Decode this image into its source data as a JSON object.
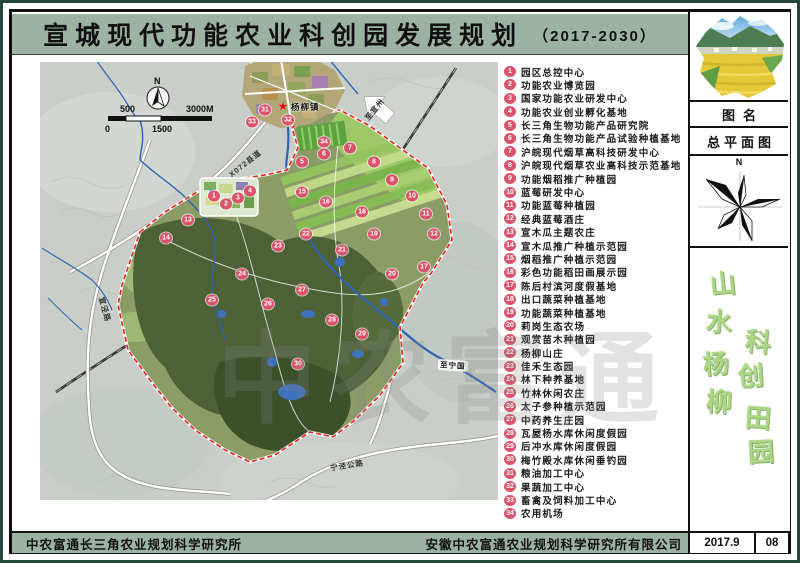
{
  "title": {
    "main": "宣城现代功能农业科创园发展规划",
    "period": "（2017-2030）"
  },
  "legend": {
    "items": [
      {
        "num": "1",
        "label": "园区总控中心"
      },
      {
        "num": "2",
        "label": "功能农业博览园"
      },
      {
        "num": "3",
        "label": "国家功能农业研发中心"
      },
      {
        "num": "4",
        "label": "功能农业创业孵化基地"
      },
      {
        "num": "5",
        "label": "长三角生物功能产品研究院"
      },
      {
        "num": "6",
        "label": "长三角生物功能产品试验种植基地"
      },
      {
        "num": "7",
        "label": "沪皖现代烟草高科技研发中心"
      },
      {
        "num": "8",
        "label": "沪皖现代烟草农业高科技示范基地"
      },
      {
        "num": "9",
        "label": "功能烟稻推广种植园"
      },
      {
        "num": "10",
        "label": "蓝莓研发中心"
      },
      {
        "num": "11",
        "label": "功能蓝莓种植园"
      },
      {
        "num": "12",
        "label": "经典蓝莓酒庄"
      },
      {
        "num": "13",
        "label": "宣木瓜主题农庄"
      },
      {
        "num": "14",
        "label": "宣木瓜推广种植示范园"
      },
      {
        "num": "15",
        "label": "烟稻推广种植示范园"
      },
      {
        "num": "16",
        "label": "彩色功能稻田画展示园"
      },
      {
        "num": "17",
        "label": "陈后村滨河度假基地"
      },
      {
        "num": "18",
        "label": "出口蔬菜种植基地"
      },
      {
        "num": "19",
        "label": "功能蔬菜种植基地"
      },
      {
        "num": "20",
        "label": "莉岗生态农场"
      },
      {
        "num": "21",
        "label": "观赏苗木种植园"
      },
      {
        "num": "22",
        "label": "杨柳山庄"
      },
      {
        "num": "23",
        "label": "佳禾生态园"
      },
      {
        "num": "24",
        "label": "林下种养基地"
      },
      {
        "num": "25",
        "label": "竹林休闲农庄"
      },
      {
        "num": "26",
        "label": "太子参种植示范园"
      },
      {
        "num": "27",
        "label": "中药养生庄园"
      },
      {
        "num": "28",
        "label": "瓦屋杨水库休闲度假园"
      },
      {
        "num": "29",
        "label": "后冲水库休闲度假园"
      },
      {
        "num": "30",
        "label": "梅竹殿水库休闲垂钓园"
      },
      {
        "num": "31",
        "label": "粮油加工中心"
      },
      {
        "num": "32",
        "label": "果蔬加工中心"
      },
      {
        "num": "33",
        "label": "畜禽及饲料加工中心"
      },
      {
        "num": "34",
        "label": "农用机场"
      }
    ]
  },
  "map": {
    "north_label": "N",
    "scale": {
      "top_left": "500",
      "top_right": "3000M",
      "bottom_left": "0",
      "bottom_mid": "1500"
    },
    "town_label": "杨柳镇",
    "town_star": "★",
    "watermark": "中农富通",
    "labels": [
      {
        "text": "X072县道",
        "x": 186,
        "y": 96,
        "rot": -38,
        "boxed": false
      },
      {
        "text": "宣泾路",
        "x": 52,
        "y": 242,
        "rot": 74,
        "boxed": false
      },
      {
        "text": "宁泾公路",
        "x": 290,
        "y": 398,
        "rot": -9,
        "boxed": false
      },
      {
        "text": "至宁国",
        "x": 398,
        "y": 298,
        "rot": 4,
        "boxed": true
      },
      {
        "text": "至宣州",
        "x": 322,
        "y": 42,
        "rot": -50,
        "boxed": false
      }
    ],
    "markers": [
      {
        "n": "1",
        "x": 174,
        "y": 134
      },
      {
        "n": "2",
        "x": 186,
        "y": 142
      },
      {
        "n": "3",
        "x": 198,
        "y": 136
      },
      {
        "n": "4",
        "x": 210,
        "y": 129
      },
      {
        "n": "5",
        "x": 262,
        "y": 100
      },
      {
        "n": "6",
        "x": 284,
        "y": 92
      },
      {
        "n": "7",
        "x": 310,
        "y": 86
      },
      {
        "n": "8",
        "x": 334,
        "y": 100
      },
      {
        "n": "9",
        "x": 352,
        "y": 118
      },
      {
        "n": "10",
        "x": 372,
        "y": 134
      },
      {
        "n": "11",
        "x": 386,
        "y": 152
      },
      {
        "n": "12",
        "x": 394,
        "y": 172
      },
      {
        "n": "13",
        "x": 148,
        "y": 158
      },
      {
        "n": "14",
        "x": 126,
        "y": 176
      },
      {
        "n": "15",
        "x": 262,
        "y": 130
      },
      {
        "n": "16",
        "x": 286,
        "y": 140
      },
      {
        "n": "17",
        "x": 384,
        "y": 205
      },
      {
        "n": "18",
        "x": 322,
        "y": 150
      },
      {
        "n": "19",
        "x": 334,
        "y": 172
      },
      {
        "n": "20",
        "x": 352,
        "y": 212
      },
      {
        "n": "21",
        "x": 302,
        "y": 188
      },
      {
        "n": "22",
        "x": 266,
        "y": 172
      },
      {
        "n": "23",
        "x": 238,
        "y": 184
      },
      {
        "n": "24",
        "x": 202,
        "y": 212
      },
      {
        "n": "25",
        "x": 172,
        "y": 238
      },
      {
        "n": "26",
        "x": 228,
        "y": 242
      },
      {
        "n": "27",
        "x": 262,
        "y": 228
      },
      {
        "n": "28",
        "x": 292,
        "y": 258
      },
      {
        "n": "29",
        "x": 322,
        "y": 272
      },
      {
        "n": "30",
        "x": 258,
        "y": 302
      },
      {
        "n": "31",
        "x": 225,
        "y": 48
      },
      {
        "n": "32",
        "x": 248,
        "y": 58
      },
      {
        "n": "33",
        "x": 212,
        "y": 60
      },
      {
        "n": "34",
        "x": 284,
        "y": 80
      }
    ]
  },
  "sidebar": {
    "field_label": "图名",
    "drawing_name": "总平面图",
    "compass_n": "N",
    "motto": [
      {
        "ch": "山",
        "x": 20,
        "y": 24,
        "rot": -6
      },
      {
        "ch": "水",
        "x": 16,
        "y": 62,
        "rot": 4
      },
      {
        "ch": "杨",
        "x": 13,
        "y": 104,
        "rot": -4
      },
      {
        "ch": "柳",
        "x": 16,
        "y": 142,
        "rot": 3
      },
      {
        "ch": "科",
        "x": 55,
        "y": 82,
        "rot": 5
      },
      {
        "ch": "创",
        "x": 48,
        "y": 116,
        "rot": -4
      },
      {
        "ch": "田",
        "x": 55,
        "y": 158,
        "rot": 4
      },
      {
        "ch": "园",
        "x": 58,
        "y": 192,
        "rot": -3
      }
    ]
  },
  "footer": {
    "left_org": "中农富通长三角农业规划科学研究所",
    "right_org": "安徽中农富通农业规划科学研究所有限公司",
    "date_month": "2017.9",
    "date_day": "08"
  },
  "colors": {
    "band_green": "#9cb3a4",
    "badge_pink": "#d9536b",
    "boundary_red": "#e12e2e",
    "river_blue": "#2f63b2",
    "area_olive": "#8b9c67",
    "motto_green": "#abd587"
  }
}
